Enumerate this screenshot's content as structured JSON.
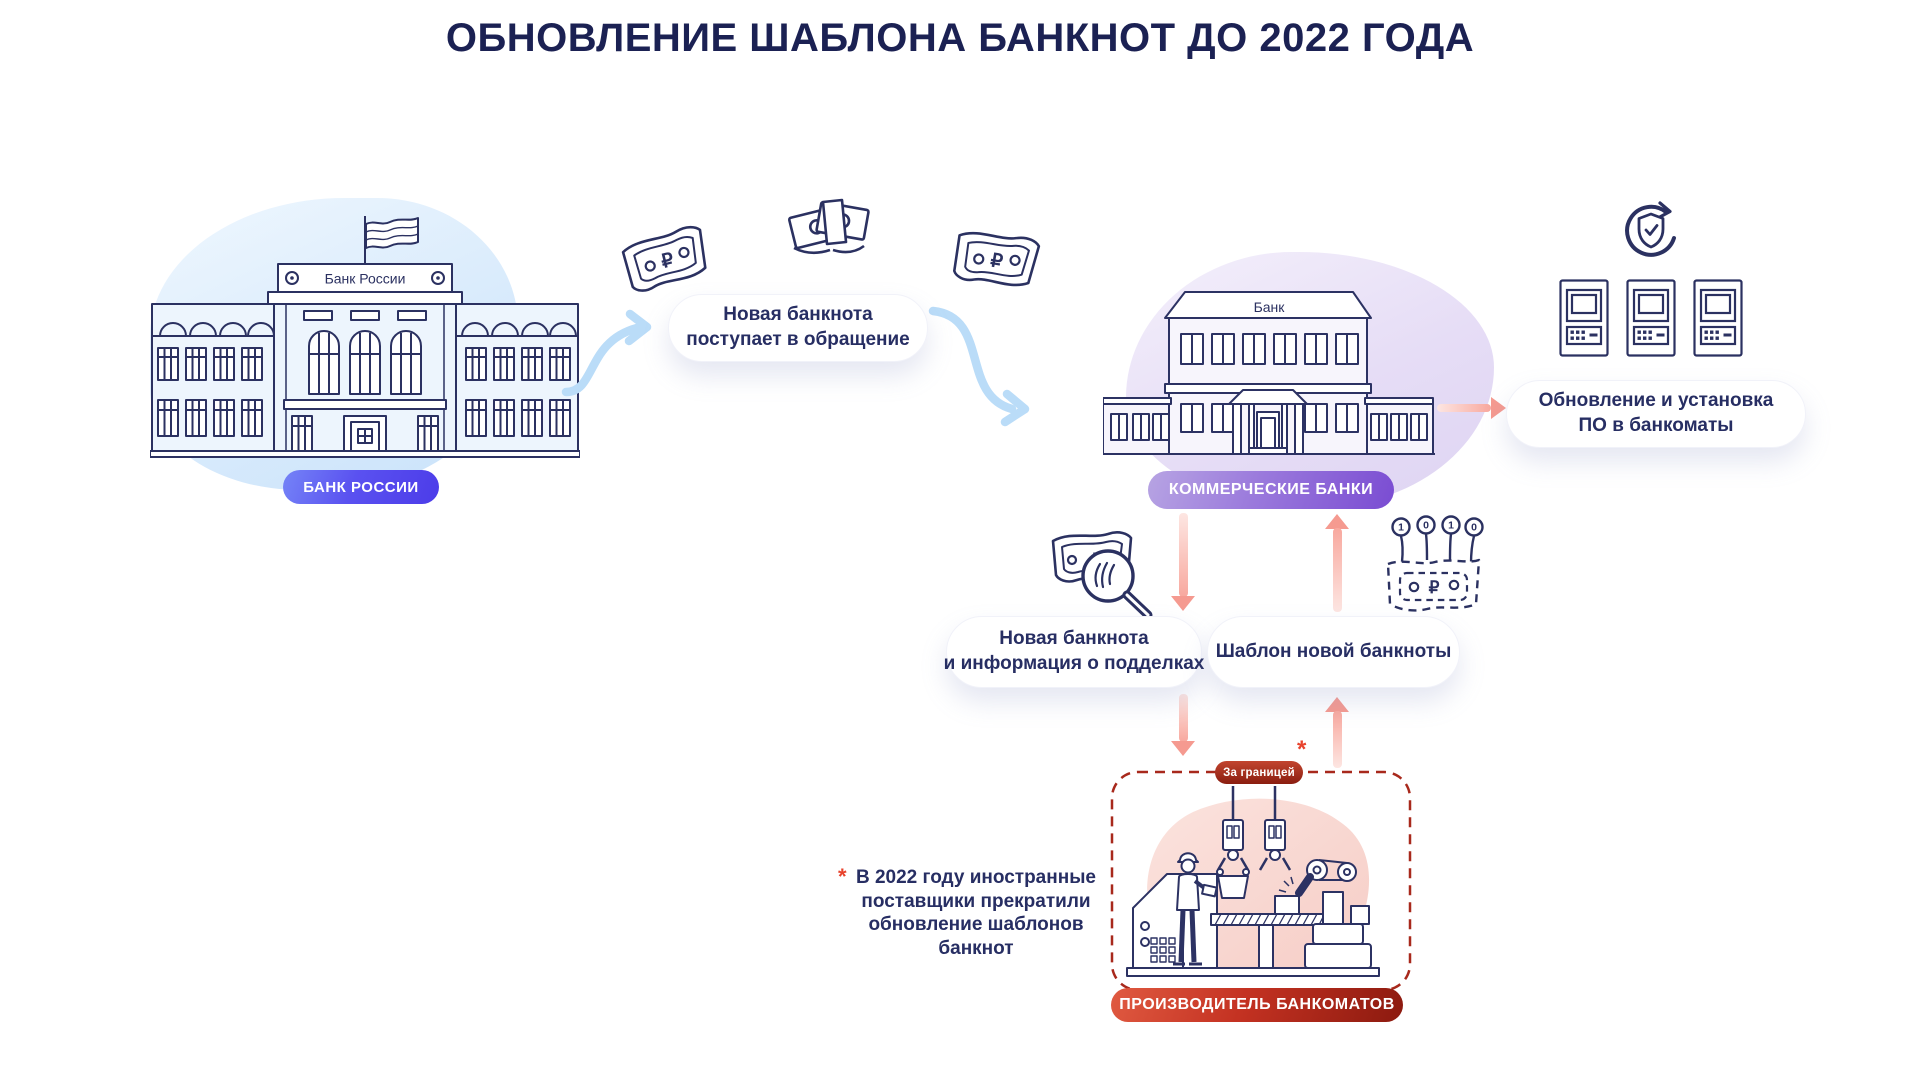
{
  "title": "ОБНОВЛЕНИЕ ШАБЛОНА БАНКНОТ ДО 2022 ГОДА",
  "bank_of_russia": {
    "label": "БАНК РОССИИ",
    "sign": "Банк России"
  },
  "commercial_banks": {
    "label": "КОММЕРЧЕСКИЕ БАНКИ",
    "sign": "Банк"
  },
  "manufacturer": {
    "label": "ПРОИЗВОДИТЕЛЬ БАНКОМАТОВ",
    "badge": "За границей",
    "asterisk": "*"
  },
  "bubbles": {
    "circulation": {
      "line1": "Новая банкнота",
      "line2": "поступает в обращение"
    },
    "software": {
      "line1": "Обновление и установка",
      "line2": "ПО в банкоматы"
    },
    "counterfeit": {
      "line1": "Новая банкнота",
      "line2": "и информация о подделках"
    },
    "template": {
      "line1": "Шаблон новой банкноты"
    }
  },
  "footnote": {
    "asterisk": "*",
    "lines": [
      "В 2022 году иностранные",
      "поставщики прекратили",
      "обновление шаблонов",
      "банкнот"
    ]
  },
  "icons": {
    "ruble_sign": "₽",
    "template_pins": [
      "1",
      "0",
      "1",
      "0"
    ]
  },
  "colors": {
    "navy": "#2b3161",
    "title": "#1b2153",
    "blue_pill": "#5a51f0",
    "purple_pill": "#8a5cd6",
    "red_pill": "#c43222",
    "arrow_blue": "#badcf8",
    "arrow_pink": "#f7a197",
    "asterisk_red": "#e8432d"
  }
}
